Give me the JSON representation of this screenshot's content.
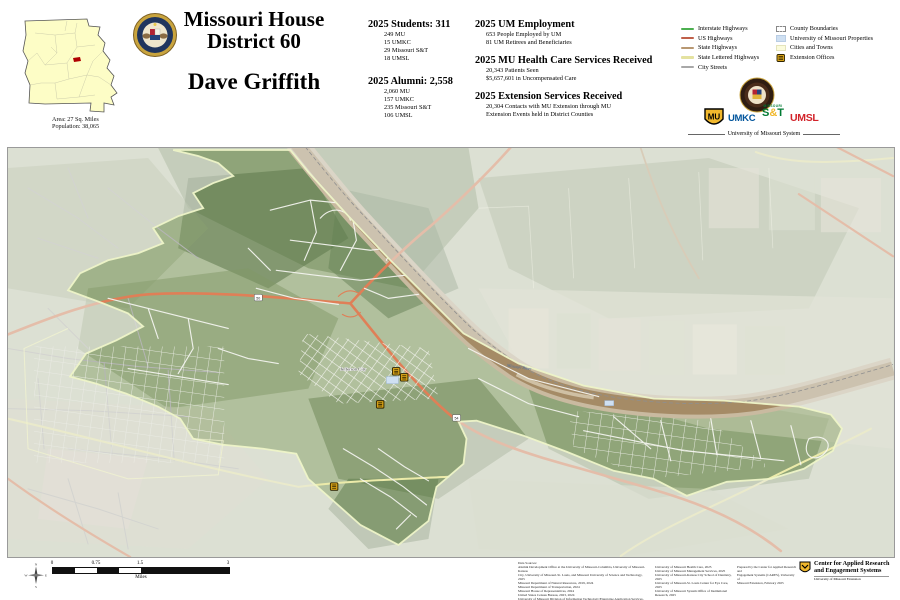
{
  "header": {
    "title_line1": "Missouri House",
    "title_line2": "District 60",
    "representative": "Dave Griffith",
    "inset": {
      "area_label": "Area: 27 Sq. Miles",
      "population_label": "Population: 38,065"
    },
    "stats": {
      "students": {
        "heading": "2025 Students: 311",
        "items": [
          "249 MU",
          "15 UMKC",
          "29 Missouri S&T",
          "18 UMSL"
        ]
      },
      "alumni": {
        "heading": "2025 Alumni: 2,558",
        "items": [
          "2,060 MU",
          "157 UMKC",
          "235 Missouri S&T",
          "106 UMSL"
        ]
      },
      "employment": {
        "heading": "2025 UM Employment",
        "items": [
          "653 People Employed by UM",
          "81 UM Retirees and Beneficiaries"
        ]
      },
      "healthcare": {
        "heading": "2025 MU Health Care Services Received",
        "items": [
          "20,343 Patients Seen",
          "$5,657,601 in Uncompensated Care"
        ]
      },
      "extension": {
        "heading": "2025 Extension Services Received",
        "items": [
          "20,304 Contacts with MU Extension through MU",
          "Extension Events held in District Counties"
        ]
      }
    },
    "legend": {
      "lines": [
        {
          "label": "Interstate Highways",
          "color": "#4caf50"
        },
        {
          "label": "US Highways",
          "color": "#c0604a"
        },
        {
          "label": "State Highways",
          "color": "#b89872"
        },
        {
          "label": "State Lettered Highways",
          "color": "#e4e2a0"
        },
        {
          "label": "City Streets",
          "color": "#a8a8a8"
        }
      ],
      "boxes": [
        {
          "label": "County Boundaries",
          "color": "#ffffff"
        },
        {
          "label": "University of Missouri Properties",
          "color": "#cfe0f2"
        },
        {
          "label": "Cities and Towns",
          "color": "#fbfbdc"
        },
        {
          "label": "Extension Offices",
          "color": "#d4a017"
        }
      ]
    },
    "logos": {
      "mu": "MU",
      "umkc": "UMKC",
      "st_small": "MISSOURI",
      "st": "S&T",
      "umsl": "UMSL",
      "system": "University of Missouri System"
    }
  },
  "map": {
    "city_label": "Jefferson City",
    "river_label": "Missouri River",
    "shield_50": "50",
    "shield_54": "54"
  },
  "footer": {
    "compass": {
      "n": "N",
      "s": "S",
      "e": "E",
      "w": "W"
    },
    "scale": {
      "ticks": [
        "0",
        "0.75",
        "1.5",
        "3"
      ],
      "unit": "Miles"
    },
    "credits_col1": [
      "Data Sources:",
      "Alumni Development Office at the University of Missouri-Columbia, University of Missouri-Kansas",
      "City, University of Missouri-St. Louis, and Missouri University of Science and Technology, 2025",
      "Missouri Department of Natural Resources, 2019, 2024",
      "Missouri Department of Transportation, 2024",
      "Missouri House of Representatives, 2024",
      "United States Census Bureau, 2023, 2024",
      "University of Missouri Division of Information Technology/Enterprise Application Services, 2025",
      "University of Missouri Extension, 2025"
    ],
    "credits_col2": [
      "University of Missouri Health Care, 2025",
      "University of Missouri Management Services, 2025",
      "University of Missouri-Kansas City School of Dentistry, 2025",
      "University of Missouri-St. Louis Center for Eye Care, 2025",
      "University of Missouri System Office of Institutional Research, 2025"
    ],
    "prepared_by": [
      "Prepared by the Center for Applied Research and",
      "Engagement Systems (CARES), University of",
      "Missouri Extension, February 2025"
    ],
    "cares": {
      "line1": "Center for Applied Research",
      "line2": "and Engagement Systems",
      "line3": "University of Missouri Extension"
    }
  }
}
